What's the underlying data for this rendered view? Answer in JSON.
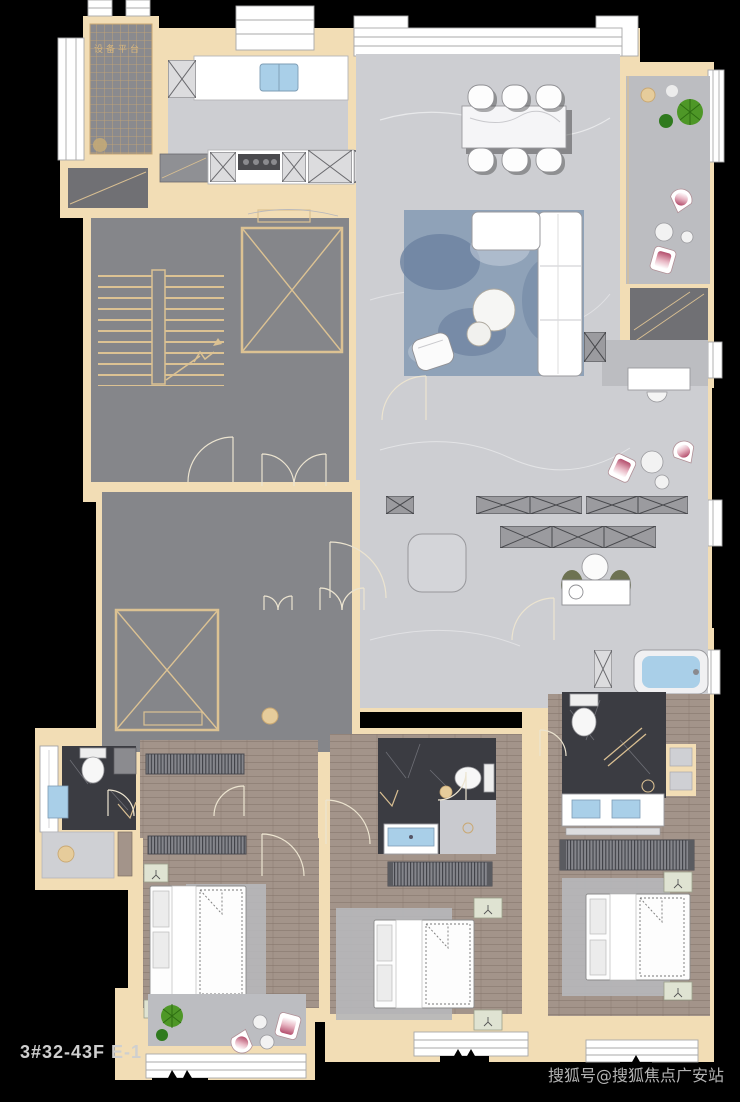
{
  "title_block": {
    "plan_code": "3#32-43F E-1"
  },
  "watermark": {
    "text": "搜狐号@搜狐焦点广安站"
  },
  "labels": {
    "equipment_platform": "设备平台"
  },
  "colors": {
    "background": "#000000",
    "wall": "#f2ddb5",
    "wall_line": "#d9bf92",
    "public_floor": "#85868a",
    "marble_floor": "#cdced2",
    "balcony_floor": "#bcbdc1",
    "wood_floor": "#a3948a",
    "dark_tile": "#3b3c42",
    "water_blue": "#a9cfe8",
    "rug_blue": "#8fa2b8",
    "accent_pink": "#bb4f6e",
    "plant_green": "#4e9727",
    "dark_platform": "#707074",
    "label_tan": "#d8b77e",
    "title_gray": "#cfcfcf",
    "watermark_gray": "#b3b3b3"
  }
}
